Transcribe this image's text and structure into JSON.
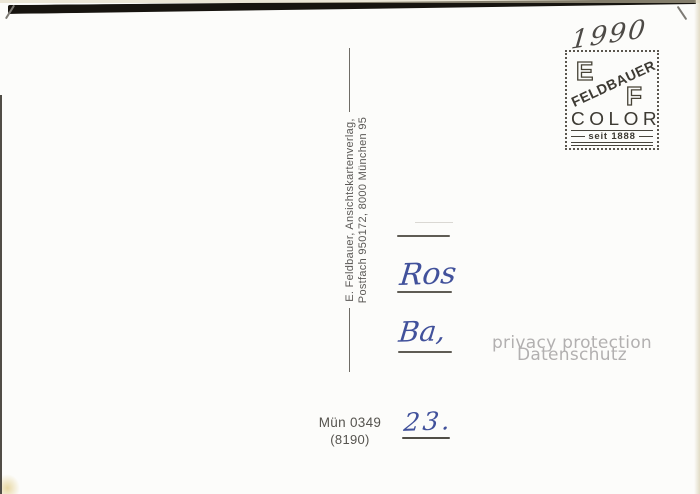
{
  "publisher": {
    "line1": "E. Feldbauer, Ansichtskartenverlag,",
    "line2": "Postfach 950172, 8000 München 95"
  },
  "stamp": {
    "letter_e": "E",
    "letter_f": "F",
    "brand": "FELDBAUER",
    "product": "COLOR",
    "since": "seit 1888"
  },
  "handwriting": {
    "year": "1990",
    "line1": "Ros",
    "line2": "Ba,",
    "line3": "23."
  },
  "order": {
    "number": "Mün 0349",
    "code": "(8190)"
  },
  "watermark": {
    "line1": "privacy protection",
    "line2": "Datenschutz"
  },
  "colors": {
    "ink_blue": "#41519b",
    "stamp_ink": "#3d3a33",
    "watermark_gray": "#b2b0b0"
  }
}
